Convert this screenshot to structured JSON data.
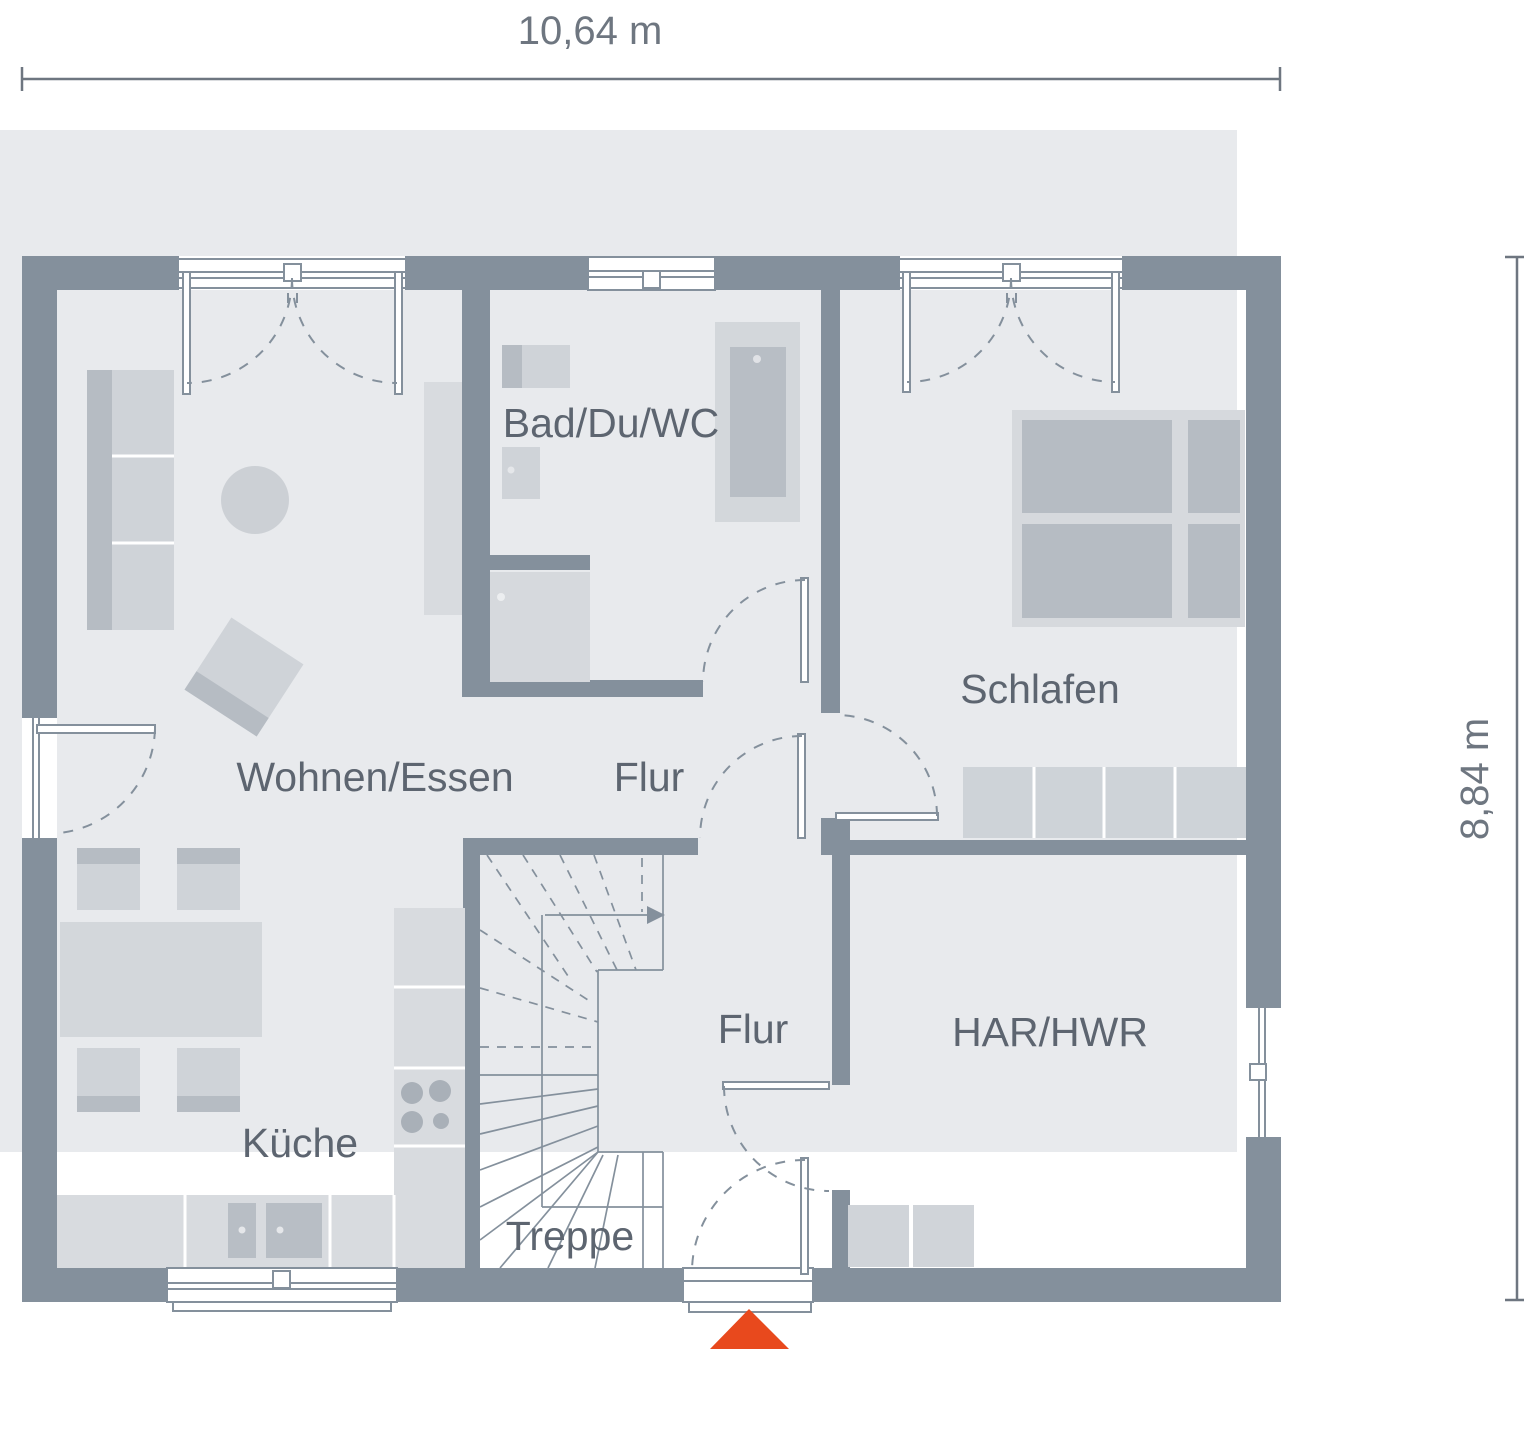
{
  "dimensions": {
    "width_label": "10,64 m",
    "height_label": "8,84 m"
  },
  "rooms": {
    "wohnen_essen": "Wohnen/Essen",
    "flur_upper": "Flur",
    "bad": "Bad/Du/WC",
    "schlafen": "Schlafen",
    "flur_lower": "Flur",
    "har_hwr": "HAR/HWR",
    "kueche": "Küche",
    "treppe": "Treppe"
  },
  "colors": {
    "wall": "#84909c",
    "site_background": "#e8eaed",
    "furniture_light": "#d8dbdf",
    "furniture_mid": "#cfd3d8",
    "furniture_dark": "#b6bcc3",
    "room_label_text": "#5d6570",
    "dimension_text": "#6e7680",
    "entrance_marker": "#e8491d"
  },
  "icons": {
    "entrance_marker": "entrance-marker-triangle",
    "stair_arrow": "stair-direction-arrow"
  }
}
